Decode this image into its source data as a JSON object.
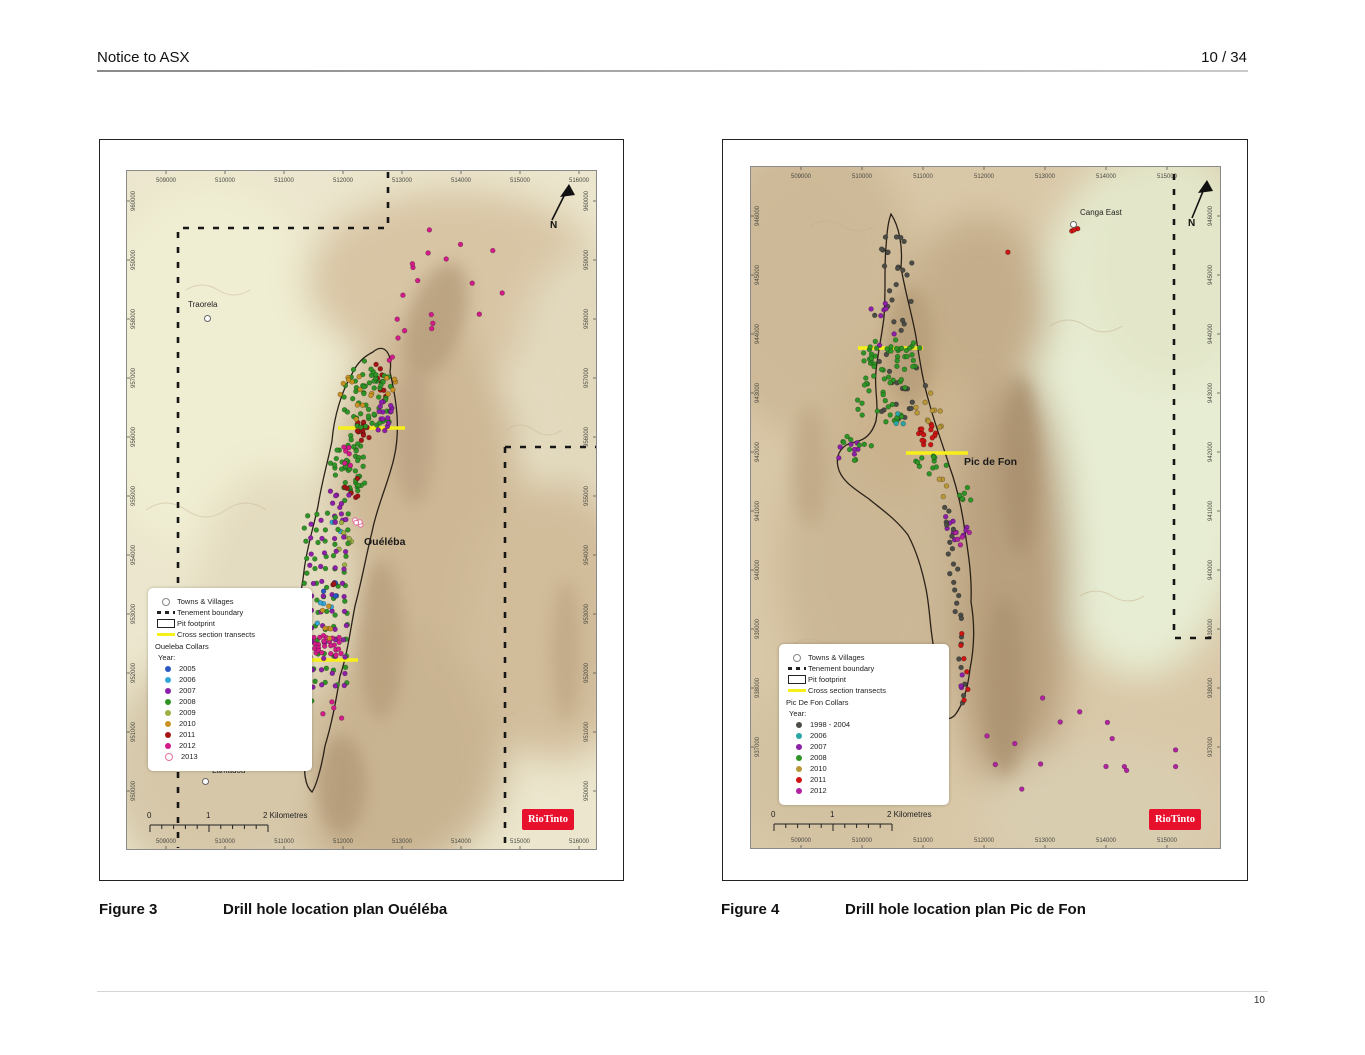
{
  "header": {
    "title": "Notice to ASX",
    "page": "10 / 34"
  },
  "footer": {
    "page_number": "10"
  },
  "figures": [
    {
      "caption_label": "Figure 3",
      "caption_text": "Drill hole location plan Ouéléba",
      "map_label": "Ouéléba",
      "north": "N",
      "logo": "RioTinto",
      "scale": {
        "zero": "0",
        "one": "1",
        "two": "2 Kilometres"
      },
      "towns": [
        {
          "name": "Traorela"
        },
        {
          "name": "Lamadou"
        }
      ],
      "grid": {
        "x_labels": [
          "509000",
          "510000",
          "511000",
          "512000",
          "513000",
          "514000",
          "515000",
          "516000"
        ],
        "y_labels": [
          "960000",
          "959000",
          "958000",
          "957000",
          "956000",
          "955000",
          "954000",
          "953000",
          "952000",
          "951000",
          "950000"
        ]
      },
      "legend": {
        "symbol_items": [
          {
            "type": "circle",
            "label": "Towns & Villages"
          },
          {
            "type": "dash",
            "label": "Tenement boundary"
          },
          {
            "type": "rect",
            "label": "Pit footprint"
          },
          {
            "type": "yellow",
            "label": "Cross section transects"
          }
        ],
        "collars_title": "Oueleba Collars",
        "year_title": "Year:",
        "years": [
          {
            "label": "2005",
            "color": "#2a59c4"
          },
          {
            "label": "2006",
            "color": "#35a7d8"
          },
          {
            "label": "2007",
            "color": "#8d1fa8"
          },
          {
            "label": "2008",
            "color": "#2e9426"
          },
          {
            "label": "2009",
            "color": "#9cb044"
          },
          {
            "label": "2010",
            "color": "#c79222"
          },
          {
            "label": "2011",
            "color": "#a31515"
          },
          {
            "label": "2012",
            "color": "#d21c8a"
          },
          {
            "label": "2013",
            "color": "#e2729f",
            "open": true
          }
        ]
      },
      "drill_clusters": [
        {
          "type": "line",
          "year": "2012",
          "x1": 262,
          "y1": 193,
          "x2": 300,
          "y2": 66,
          "n": 11,
          "j": 7
        },
        {
          "type": "scatter",
          "year": "2012",
          "cx": 342,
          "cy": 108,
          "rx": 42,
          "ry": 40,
          "n": 6
        },
        {
          "type": "scatter",
          "year": "2012",
          "cx": 300,
          "cy": 152,
          "rx": 12,
          "ry": 10,
          "n": 3
        },
        {
          "type": "line",
          "year": "2011",
          "x1": 251,
          "y1": 196,
          "x2": 259,
          "y2": 230,
          "n": 9,
          "j": 4
        },
        {
          "type": "scatter",
          "year": "2011",
          "cx": 237,
          "cy": 260,
          "rx": 9,
          "ry": 12,
          "n": 14
        },
        {
          "type": "scatter",
          "year": "2008",
          "cx": 243,
          "cy": 228,
          "rx": 26,
          "ry": 38,
          "n": 60
        },
        {
          "type": "scatter",
          "year": "2008",
          "cx": 222,
          "cy": 300,
          "rx": 18,
          "ry": 35,
          "n": 45
        },
        {
          "type": "scatter",
          "year": "2007",
          "cx": 257,
          "cy": 247,
          "rx": 11,
          "ry": 17,
          "n": 16
        },
        {
          "type": "scatter",
          "year": "2010",
          "cx": 230,
          "cy": 226,
          "rx": 16,
          "ry": 28,
          "n": 12
        },
        {
          "type": "scatter",
          "year": "2010",
          "cx": 263,
          "cy": 212,
          "rx": 8,
          "ry": 12,
          "n": 5
        },
        {
          "type": "scatter",
          "year": "2012",
          "cx": 222,
          "cy": 283,
          "rx": 6,
          "ry": 16,
          "n": 6
        },
        {
          "type": "scatter",
          "year": "2011",
          "cx": 226,
          "cy": 318,
          "rx": 8,
          "ry": 14,
          "n": 6
        },
        {
          "type": "scatter",
          "year": "2007",
          "cx": 212,
          "cy": 330,
          "rx": 14,
          "ry": 22,
          "n": 10
        },
        {
          "type": "scatter",
          "year": "2006",
          "cx": 212,
          "cy": 358,
          "rx": 8,
          "ry": 10,
          "n": 3
        },
        {
          "type": "scatter",
          "year": "2013",
          "cx": 232,
          "cy": 352,
          "rx": 10,
          "ry": 14,
          "n": 4
        },
        {
          "type": "scatter",
          "year": "2009",
          "cx": 215,
          "cy": 372,
          "rx": 12,
          "ry": 25,
          "n": 8
        },
        {
          "type": "grid",
          "year": "2008",
          "x": 180,
          "y": 345,
          "cols": 5,
          "rows": 13,
          "dx": 10,
          "dy": 14
        },
        {
          "type": "grid",
          "year": "2007",
          "x": 186,
          "y": 352,
          "cols": 4,
          "rows": 12,
          "dx": 11,
          "dy": 15
        },
        {
          "type": "grid",
          "year": "2012",
          "x": 188,
          "y": 468,
          "cols": 6,
          "rows": 4,
          "dx": 5,
          "dy": 5
        },
        {
          "type": "scatter",
          "year": "2005",
          "cx": 206,
          "cy": 428,
          "rx": 10,
          "ry": 18,
          "n": 4
        },
        {
          "type": "scatter",
          "year": "2006",
          "cx": 198,
          "cy": 442,
          "rx": 10,
          "ry": 18,
          "n": 4
        },
        {
          "type": "scatter",
          "year": "2010",
          "cx": 200,
          "cy": 452,
          "rx": 10,
          "ry": 20,
          "n": 6
        },
        {
          "type": "scatter",
          "year": "2011",
          "cx": 208,
          "cy": 412,
          "rx": 3,
          "ry": 3,
          "n": 2
        },
        {
          "type": "line",
          "year": "2008",
          "x1": 185,
          "y1": 520,
          "x2": 172,
          "y2": 600,
          "n": 14,
          "j": 6
        },
        {
          "type": "line",
          "year": "2007",
          "x1": 182,
          "y1": 525,
          "x2": 170,
          "y2": 585,
          "n": 7,
          "j": 5
        },
        {
          "type": "scatter",
          "year": "2012",
          "cx": 210,
          "cy": 545,
          "rx": 15,
          "ry": 15,
          "n": 4
        }
      ]
    },
    {
      "caption_label": "Figure 4",
      "caption_text": "Drill hole location plan Pic de Fon",
      "map_label": "Pic de Fon",
      "north": "N",
      "logo": "RioTinto",
      "scale": {
        "zero": "0",
        "one": "1",
        "two": "2 Kilometres"
      },
      "towns": [
        {
          "name": "Canga East"
        }
      ],
      "grid": {
        "x_labels": [
          "509000",
          "510000",
          "511000",
          "512000",
          "513000",
          "514000",
          "515000"
        ],
        "y_labels": [
          "946000",
          "945000",
          "944000",
          "943000",
          "942000",
          "941000",
          "940000",
          "939000",
          "938000",
          "937000"
        ]
      },
      "legend": {
        "symbol_items": [
          {
            "type": "circle",
            "label": "Towns & Villages"
          },
          {
            "type": "dash",
            "label": "Tenement boundary"
          },
          {
            "type": "rect",
            "label": "Pit footprint"
          },
          {
            "type": "yellow",
            "label": "Cross section transects"
          }
        ],
        "collars_title": "Pic De Fon Collars",
        "year_title": "Year:",
        "years": [
          {
            "label": "1998 - 2004",
            "color": "#4c4c46"
          },
          {
            "label": "2006",
            "color": "#2aa6a6"
          },
          {
            "label": "2007",
            "color": "#8d1fa8"
          },
          {
            "label": "2008",
            "color": "#2e9426"
          },
          {
            "label": "2010",
            "color": "#b99737"
          },
          {
            "label": "2011",
            "color": "#cf1414"
          },
          {
            "label": "2012",
            "color": "#b0249f"
          }
        ]
      },
      "drill_clusters": [
        {
          "type": "scatter",
          "year": "1998 - 2004",
          "cx": 143,
          "cy": 120,
          "rx": 22,
          "ry": 55,
          "n": 24
        },
        {
          "type": "scatter",
          "year": "1998 - 2004",
          "cx": 150,
          "cy": 215,
          "rx": 30,
          "ry": 40,
          "n": 18
        },
        {
          "type": "scatter",
          "year": "2007",
          "cx": 128,
          "cy": 155,
          "rx": 18,
          "ry": 30,
          "n": 7
        },
        {
          "type": "scatter",
          "year": "2008",
          "cx": 142,
          "cy": 188,
          "rx": 32,
          "ry": 18,
          "n": 40
        },
        {
          "type": "scatter",
          "year": "2008",
          "cx": 135,
          "cy": 232,
          "rx": 33,
          "ry": 25,
          "n": 30
        },
        {
          "type": "scatter",
          "year": "2010",
          "cx": 170,
          "cy": 238,
          "rx": 25,
          "ry": 12,
          "n": 6
        },
        {
          "type": "scatter",
          "year": "2006",
          "cx": 152,
          "cy": 252,
          "rx": 10,
          "ry": 8,
          "n": 3
        },
        {
          "type": "scatter",
          "year": "2007",
          "cx": 103,
          "cy": 287,
          "rx": 16,
          "ry": 12,
          "n": 7
        },
        {
          "type": "scatter",
          "year": "2008",
          "cx": 108,
          "cy": 282,
          "rx": 20,
          "ry": 14,
          "n": 10
        },
        {
          "type": "scatter",
          "year": "2011",
          "cx": 177,
          "cy": 268,
          "rx": 9,
          "ry": 13,
          "n": 16
        },
        {
          "type": "scatter",
          "year": "2010",
          "cx": 186,
          "cy": 252,
          "rx": 10,
          "ry": 10,
          "n": 5
        },
        {
          "type": "scatter",
          "year": "2008",
          "cx": 178,
          "cy": 295,
          "rx": 20,
          "ry": 15,
          "n": 12
        },
        {
          "type": "scatter",
          "year": "2010",
          "cx": 192,
          "cy": 322,
          "rx": 10,
          "ry": 10,
          "n": 4
        },
        {
          "type": "scatter",
          "year": "2008",
          "cx": 215,
          "cy": 330,
          "rx": 12,
          "ry": 10,
          "n": 6
        },
        {
          "type": "scatter",
          "year": "2007",
          "cx": 205,
          "cy": 360,
          "rx": 14,
          "ry": 14,
          "n": 10
        },
        {
          "type": "scatter",
          "year": "2012",
          "cx": 210,
          "cy": 372,
          "rx": 12,
          "ry": 10,
          "n": 5
        },
        {
          "type": "line",
          "year": "1998 - 2004",
          "x1": 196,
          "y1": 340,
          "x2": 208,
          "y2": 450,
          "n": 18,
          "j": 5
        },
        {
          "type": "line",
          "year": "1998 - 2004",
          "x1": 208,
          "y1": 455,
          "x2": 213,
          "y2": 540,
          "n": 8,
          "j": 4
        },
        {
          "type": "line",
          "year": "2011",
          "x1": 212,
          "y1": 468,
          "x2": 217,
          "y2": 535,
          "n": 6,
          "j": 3
        },
        {
          "type": "scatter",
          "year": "2007",
          "cx": 214,
          "cy": 515,
          "rx": 6,
          "ry": 10,
          "n": 3
        },
        {
          "type": "scatter",
          "year": "2012",
          "cx": 330,
          "cy": 575,
          "rx": 105,
          "ry": 65,
          "n": 15
        },
        {
          "type": "scatter",
          "year": "2011",
          "cx": 326,
          "cy": 65,
          "rx": 5,
          "ry": 4,
          "n": 3
        },
        {
          "type": "scatter",
          "year": "2011",
          "cx": 256,
          "cy": 88,
          "rx": 3,
          "ry": 3,
          "n": 1
        }
      ]
    }
  ]
}
